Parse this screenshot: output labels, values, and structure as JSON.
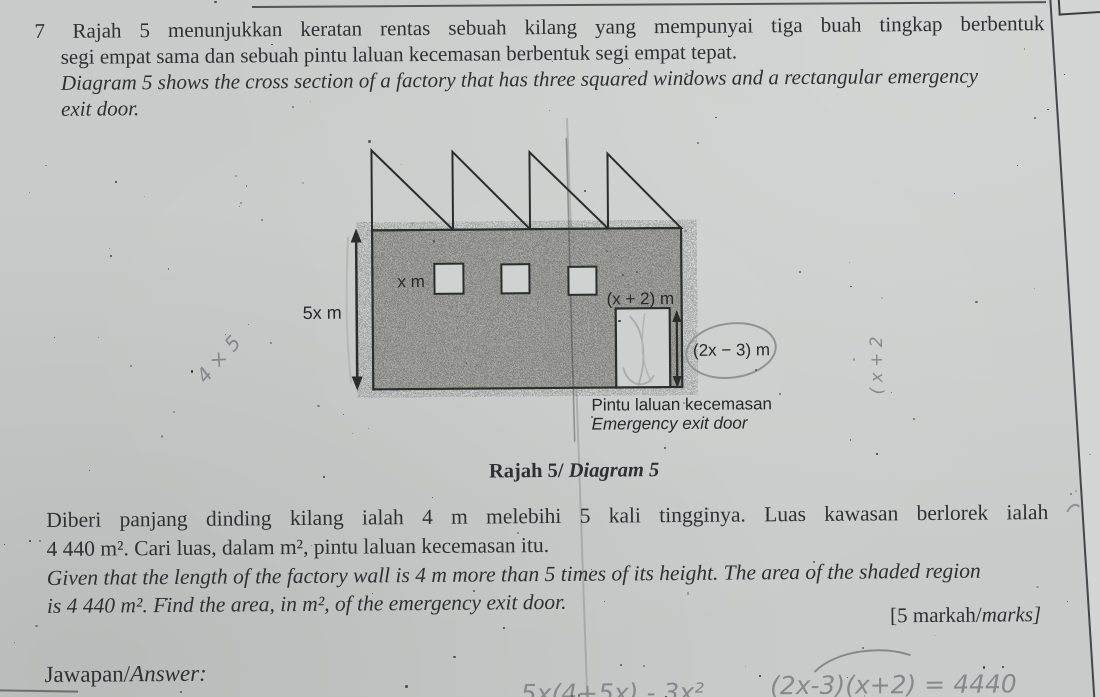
{
  "colors": {
    "paper": "#c8cbc9",
    "paper_edge": "#d2d5d3",
    "ink": "#2e3033",
    "line": "#2b2c2e",
    "pencil": "#85898b",
    "wall_fill": "#a4a59f",
    "window_fill": "#cfd2d0"
  },
  "question": {
    "number": "7",
    "lines": [
      "Rajah 5 menunjukkan keratan rentas sebuah kilang yang mempunyai tiga buah tingkap berbentuk",
      "segi empat sama dan sebuah pintu laluan kecemasan berbentuk segi empat tepat.",
      "Diagram 5 shows the cross section of a factory that has three squared windows and a rectangular emergency",
      "exit door."
    ]
  },
  "diagram": {
    "labels": {
      "window_size": "x m",
      "wall_height": "5x m",
      "door_width": "(x + 2) m",
      "door_height": "(2x − 3) m",
      "door_caption_malay": "Pintu laluan kecemasan",
      "door_caption_english": "Emergency exit door"
    },
    "caption": {
      "bold": "Rajah 5/",
      "italic": " Diagram 5"
    }
  },
  "problem": {
    "lines": [
      "Diberi panjang dinding kilang ialah 4 m melebihi 5 kali tingginya. Luas kawasan berlorek ialah",
      "4 440 m². Cari luas, dalam m², pintu laluan kecemasan itu.",
      "Given that the length of the factory wall is 4 m more than 5 times of its height. The area of the shaded region",
      "is 4 440 m². Find the area, in m², of the emergency exit door."
    ],
    "marks": {
      "upright": "[5 markah/",
      "italic": "marks]"
    }
  },
  "answer_label": {
    "upright": "Jawapan/",
    "italic": "Answer:"
  },
  "handwriting": {
    "diagonal_note": "4 × 5",
    "vertical_note": "( x + 2",
    "work_left": "5x(4+5x) - 3x²",
    "work_right": "(2x-3)(x+2) = 4440"
  }
}
